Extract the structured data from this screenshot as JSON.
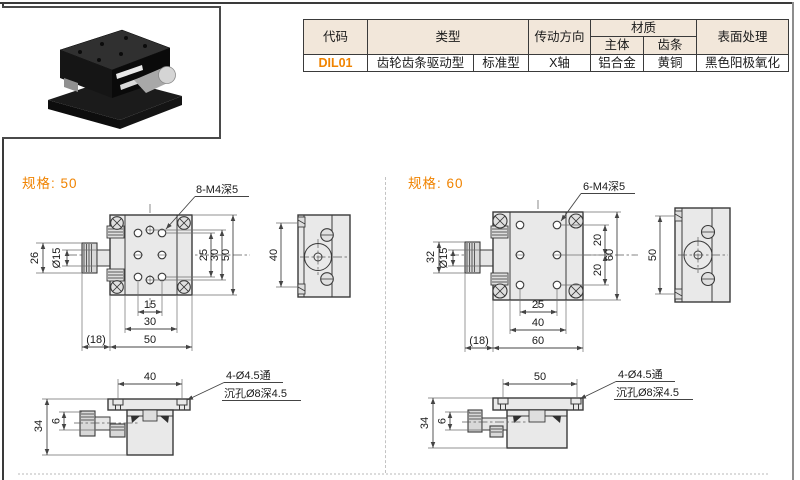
{
  "colors": {
    "accent": "#f08300",
    "table_header_bg": "#f2e7da",
    "drawing_fill": "#e9e9e9",
    "drawing_line": "#3a3a3a"
  },
  "table": {
    "headers": {
      "code": "代码",
      "type": "类型",
      "direction": "传动方向",
      "material": "材质",
      "material_body": "主体",
      "material_rack": "齿条",
      "surface": "表面处理"
    },
    "row": {
      "code": "DIL01",
      "type_main": "齿轮齿条驱动型",
      "type_sub": "标准型",
      "direction": "X轴",
      "material_body": "铝合金",
      "material_rack": "黄铜",
      "surface": "黑色阳极氧化"
    }
  },
  "spec50": {
    "title": "规格: 50",
    "top_view": {
      "callout": "8-M4深5",
      "knob_height": "26",
      "shaft_dia": "Ø15",
      "right_inner": "25",
      "right_mid": "30",
      "right_outer": "50",
      "bottom_inner": "15",
      "bottom_mid": "30",
      "bottom_outer": "50",
      "knob_offset": "(18)"
    },
    "side_view": {
      "hole_span": "40"
    },
    "front_view": {
      "hole_span": "40",
      "callout_hole": "4-Ø4.5通",
      "callout_cbore": "沉孔Ø8深4.5",
      "height": "34",
      "shaft_center": "6"
    }
  },
  "spec60": {
    "title": "规格: 60",
    "top_view": {
      "callout": "6-M4深5",
      "knob_height": "32",
      "shaft_dia": "Ø15",
      "right_inner1": "20",
      "right_inner2": "20",
      "right_outer": "60",
      "bottom_inner": "25",
      "bottom_mid": "40",
      "bottom_outer": "60",
      "knob_offset": "(18)"
    },
    "side_view": {
      "hole_span": "50"
    },
    "front_view": {
      "hole_span": "50",
      "callout_hole": "4-Ø4.5通",
      "callout_cbore": "沉孔Ø8深4.5",
      "height": "34",
      "shaft_center": "6"
    }
  }
}
